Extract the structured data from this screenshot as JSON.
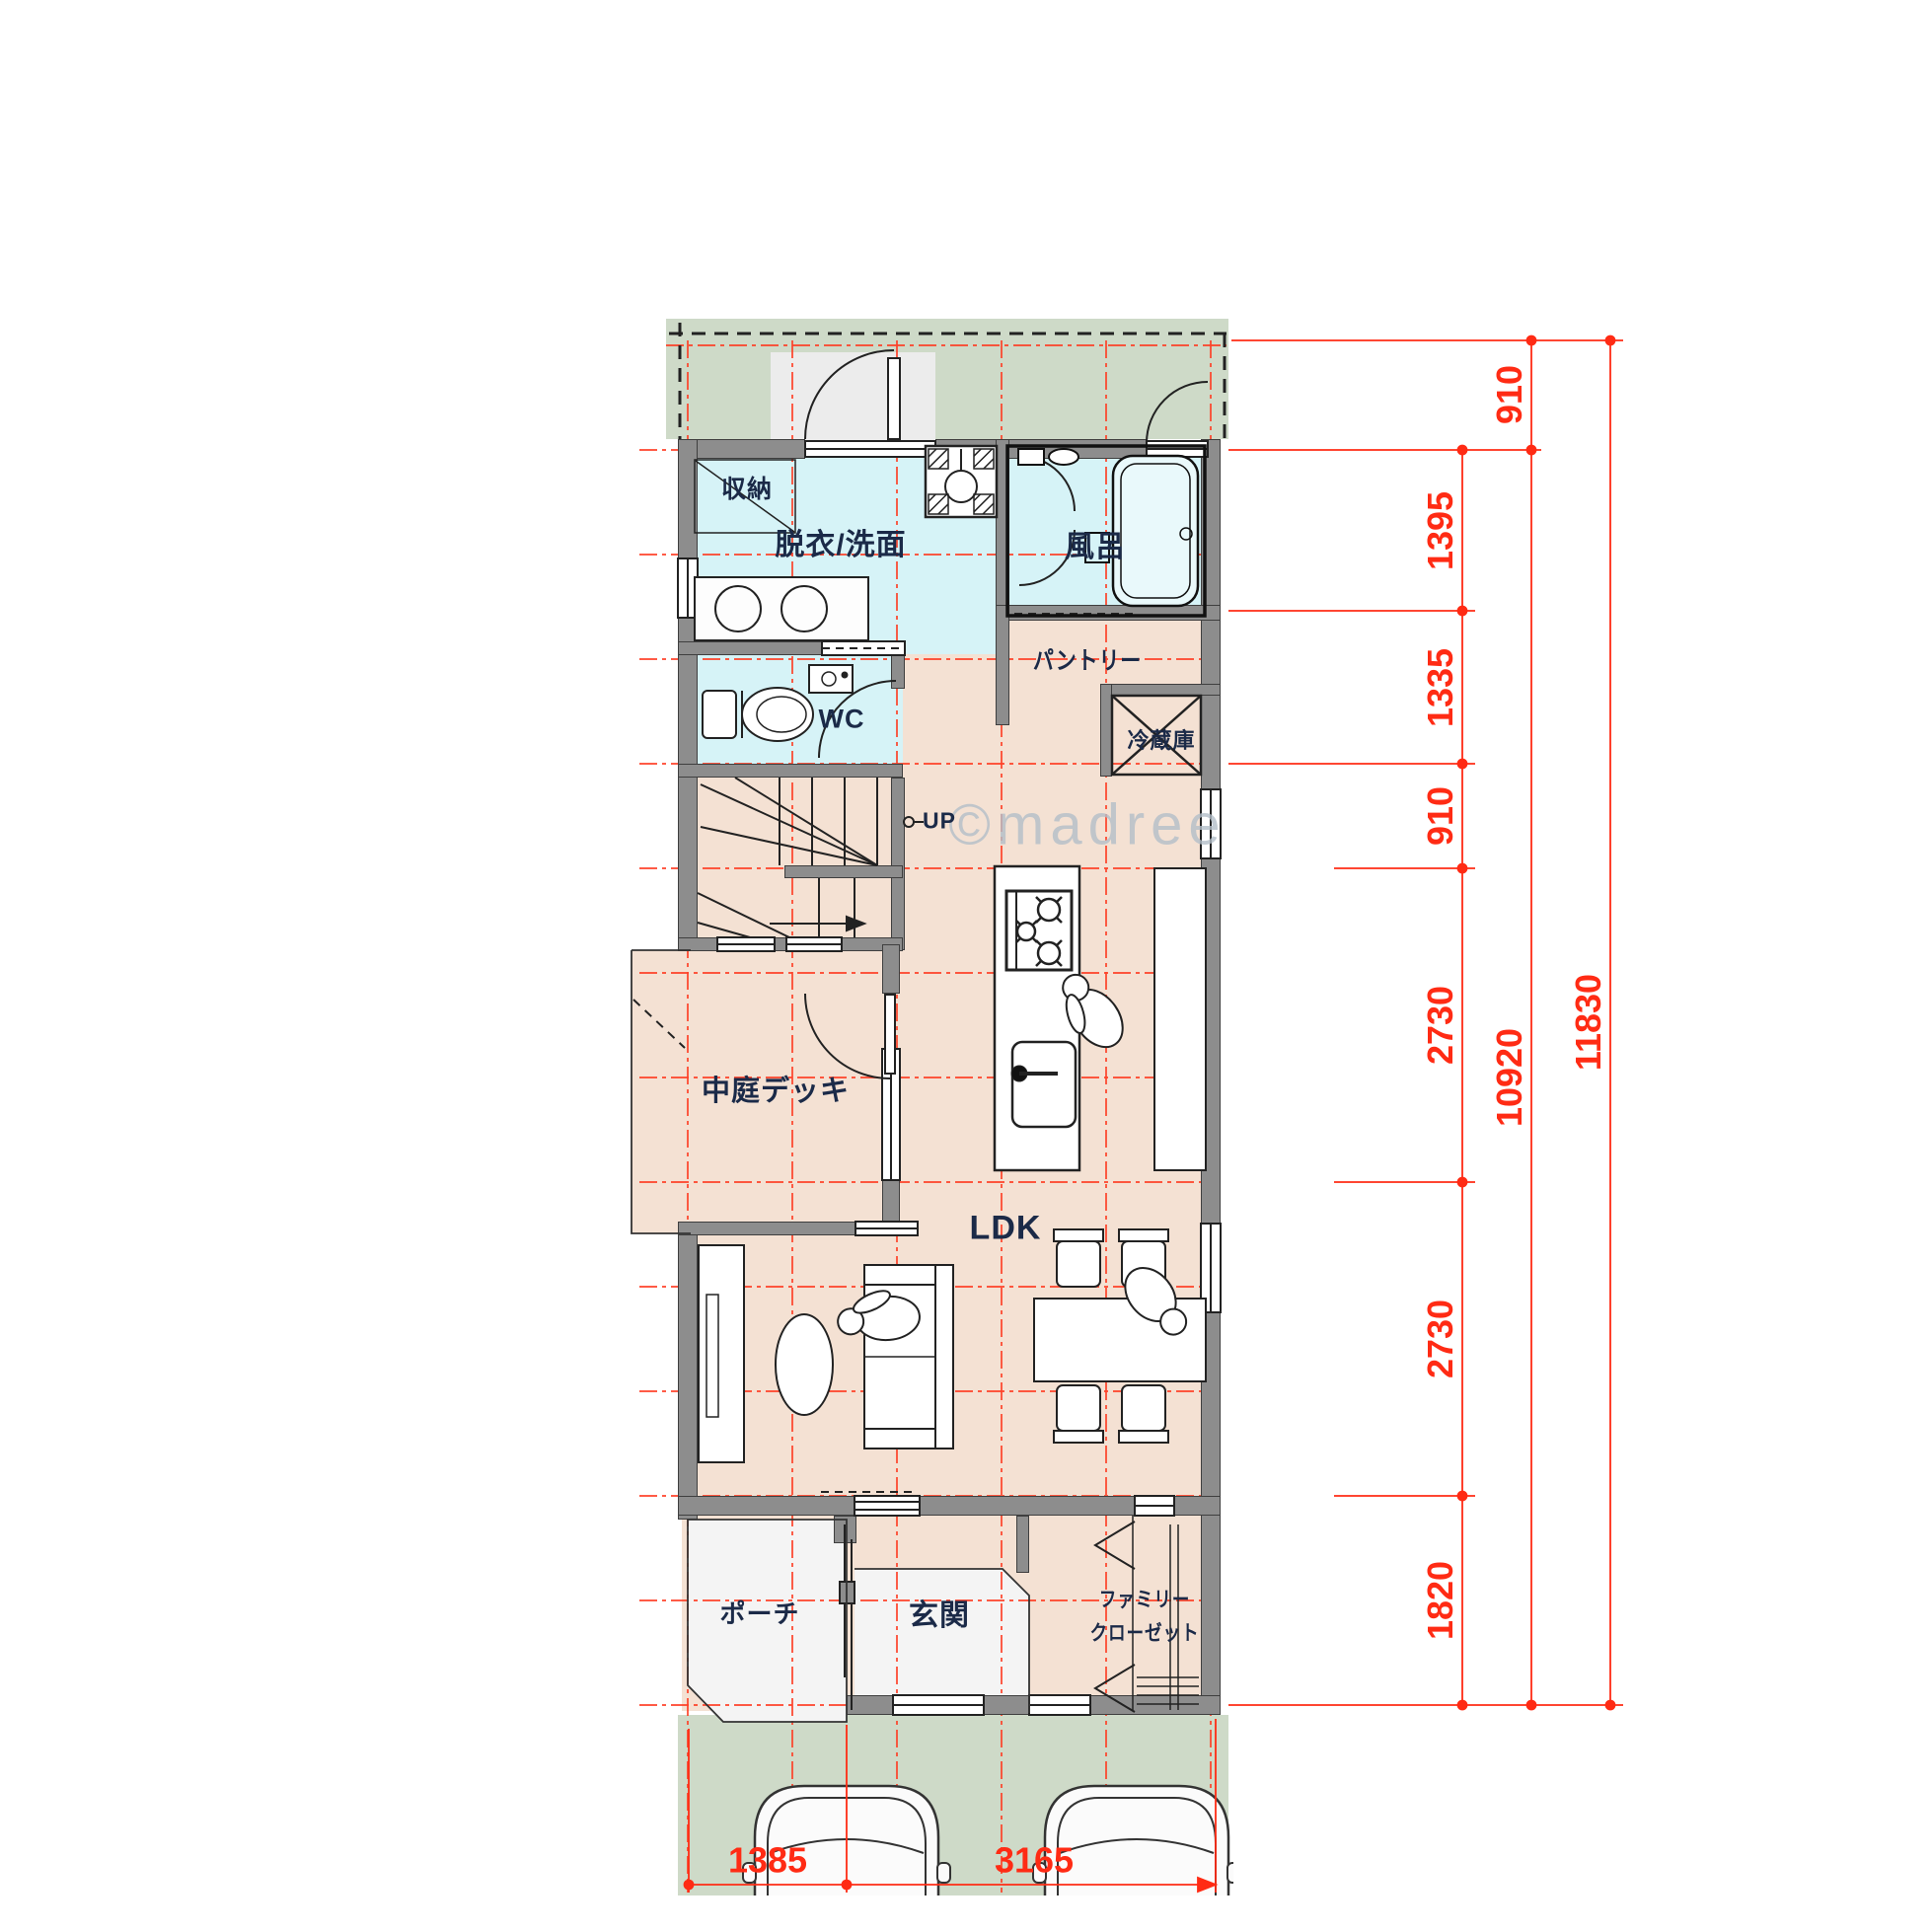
{
  "rooms": {
    "storage": {
      "label": "収納"
    },
    "washroom": {
      "label": "脱衣/洗面"
    },
    "bath": {
      "label": "風呂"
    },
    "wc": {
      "label": "WC"
    },
    "pantry": {
      "label": "パントリー"
    },
    "fridge": {
      "label": "冷蔵庫"
    },
    "stairs": {
      "up_label": "UP"
    },
    "deck": {
      "label": "中庭デッキ"
    },
    "ldk": {
      "label": "LDK"
    },
    "porch": {
      "label": "ポーチ"
    },
    "entrance": {
      "label": "玄関"
    },
    "family_closet": {
      "label_line1": "ファミリー",
      "label_line2": "クローゼット"
    }
  },
  "dimensions": {
    "right_segments": [
      "910",
      "1395",
      "1335",
      "910",
      "2730",
      "2730",
      "1820"
    ],
    "right_totals": [
      "10920",
      "11830"
    ],
    "bottom": [
      "1385",
      "3165"
    ]
  },
  "watermark": "©madree",
  "colors": {
    "floor_beige": "#f4e1d3",
    "wet_cyan": "#d6f3f7",
    "site_green": "#cedac8",
    "wall_gray": "#8d8d8d",
    "dim_red": "#ff2b14",
    "label_navy": "#1b2a48"
  }
}
